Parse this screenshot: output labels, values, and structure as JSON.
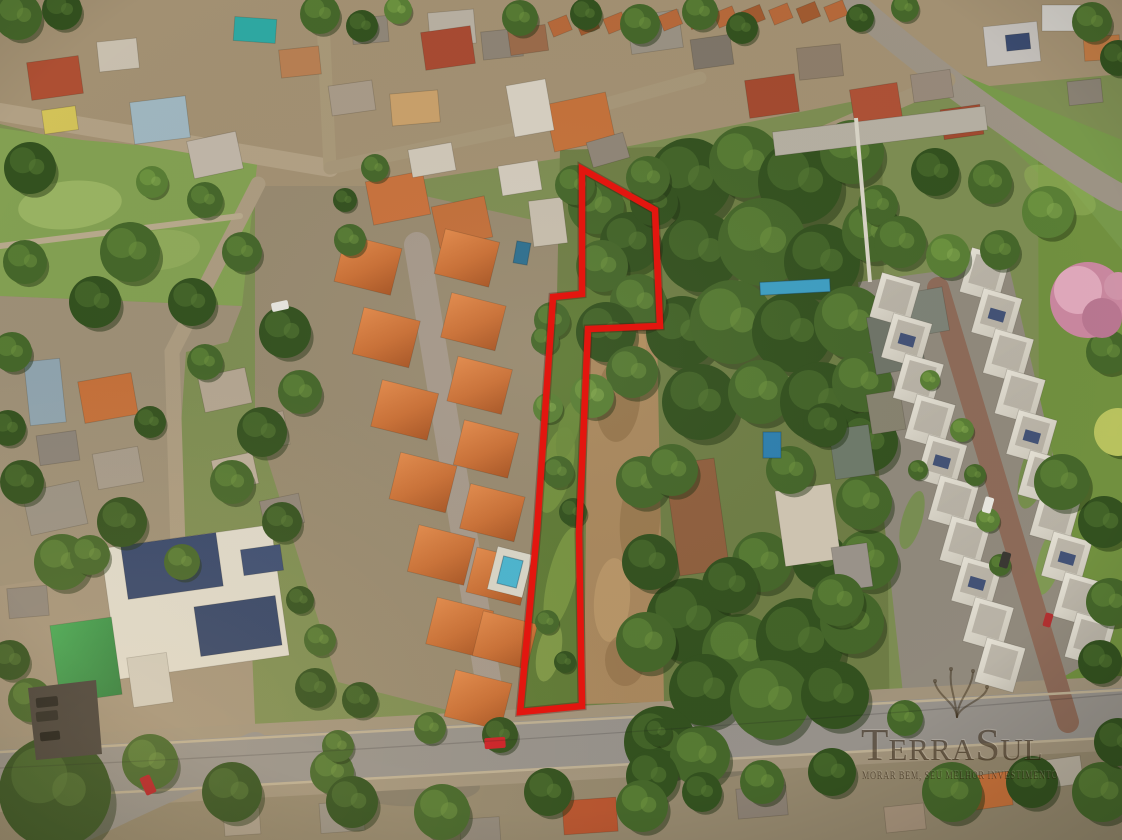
{
  "photo": {
    "type": "aerial-drone-photograph",
    "subject": "residential neighborhood with red-outlined vacant lot for sale",
    "width_px": 1122,
    "height_px": 840
  },
  "boundary": {
    "color": "#e3160f",
    "stroke_width": 6.5,
    "points": "582,169 655,210 660,326 588,329 579,533 582,706 520,712 537,530 553,297 582,294"
  },
  "lot": {
    "grass_fill": "#5f7a36"
  },
  "watermark": {
    "brand": "TerraSul",
    "brand_parts": {
      "t1": "T",
      "t2": "ERRA",
      "t3": "S",
      "t4": "UL"
    },
    "tagline": "MORAR BEM, SEU MELHOR INVESTIMENTO",
    "color": "rgba(40,26,10,0.62)",
    "highlight": "rgba(255,248,230,0.22)"
  },
  "palette": {
    "boundary_red": "#e3160f",
    "terracotta_roof": "#c96f35",
    "vegetation_green": "#45662a",
    "road_gray": "#96918a",
    "dirt_tan": "#a8875d",
    "pool_blue": "#49b4cf",
    "solar_panel_blue": "#35466b",
    "pink_ipe_tree": "#c9879f"
  }
}
